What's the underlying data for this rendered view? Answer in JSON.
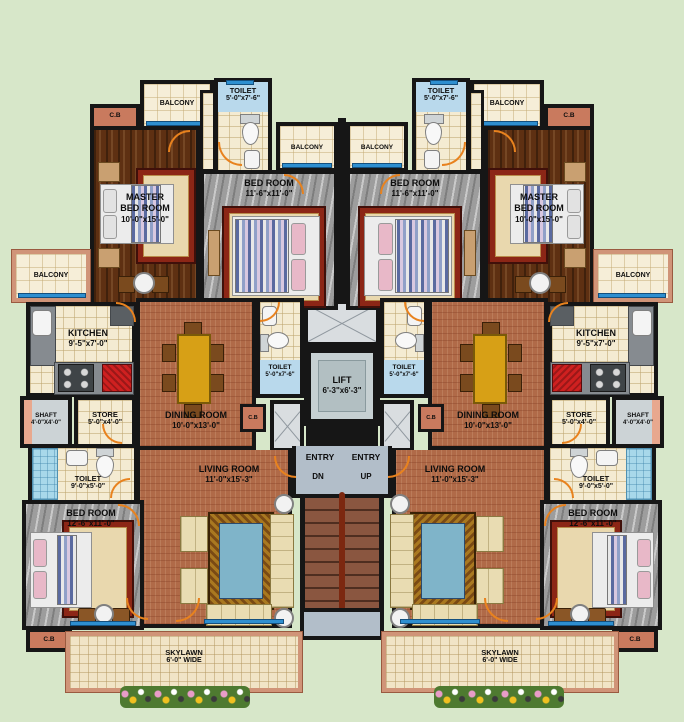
{
  "palette": {
    "background": "#d7e7c9",
    "wall": "#161616",
    "wood_floor": "#5e3012",
    "marble_floor": "#9d9d9d",
    "terracotta_floor": "#b06a48",
    "tile_floor": "#f4ebd2",
    "window_blue": "#2e8fd0",
    "cupboard_salmon": "#c97a5e",
    "door_arc_orange": "#e8821e",
    "stairs_brown": "#8a5640",
    "lobby_gray": "#b2bec9"
  },
  "labels": {
    "balcony": "BALCONY",
    "cb": "C.B",
    "entry": "ENTRY",
    "dn": "DN",
    "up": "UP"
  },
  "rooms": {
    "master": {
      "line1": "MASTER",
      "line2": "BED ROOM",
      "dims": "10'-0\"x15'-0\""
    },
    "bed_top": {
      "name": "BED ROOM",
      "dims": "11'-6\"x11'-0\""
    },
    "bed_bottom": {
      "name": "BED ROOM",
      "dims": "12'-6\"x11'-0\""
    },
    "toilet_small": {
      "name": "TOILET",
      "dims": "5'-0\"x7'-6\""
    },
    "toilet_big": {
      "name": "TOILET",
      "dims": "9'-0\"x5'-0\""
    },
    "kitchen": {
      "name": "KITCHEN",
      "dims": "9'-5\"x7'-0\""
    },
    "shaft": {
      "name": "SHAFT",
      "dims": "4'-0\"X4'-0\""
    },
    "store": {
      "name": "STORE",
      "dims": "5'-0\"x4'-0\""
    },
    "dining": {
      "name": "DINING ROOM",
      "dims": "10'-0\"x13'-0\""
    },
    "living": {
      "name": "LIVING ROOM",
      "dims": "11'-0\"x15'-3\""
    },
    "lift": {
      "name": "LIFT",
      "dims": "6'-3\"x6'-3\""
    },
    "skylawn": {
      "name": "SKYLAWN",
      "dims": "6'-0\" WIDE"
    }
  }
}
